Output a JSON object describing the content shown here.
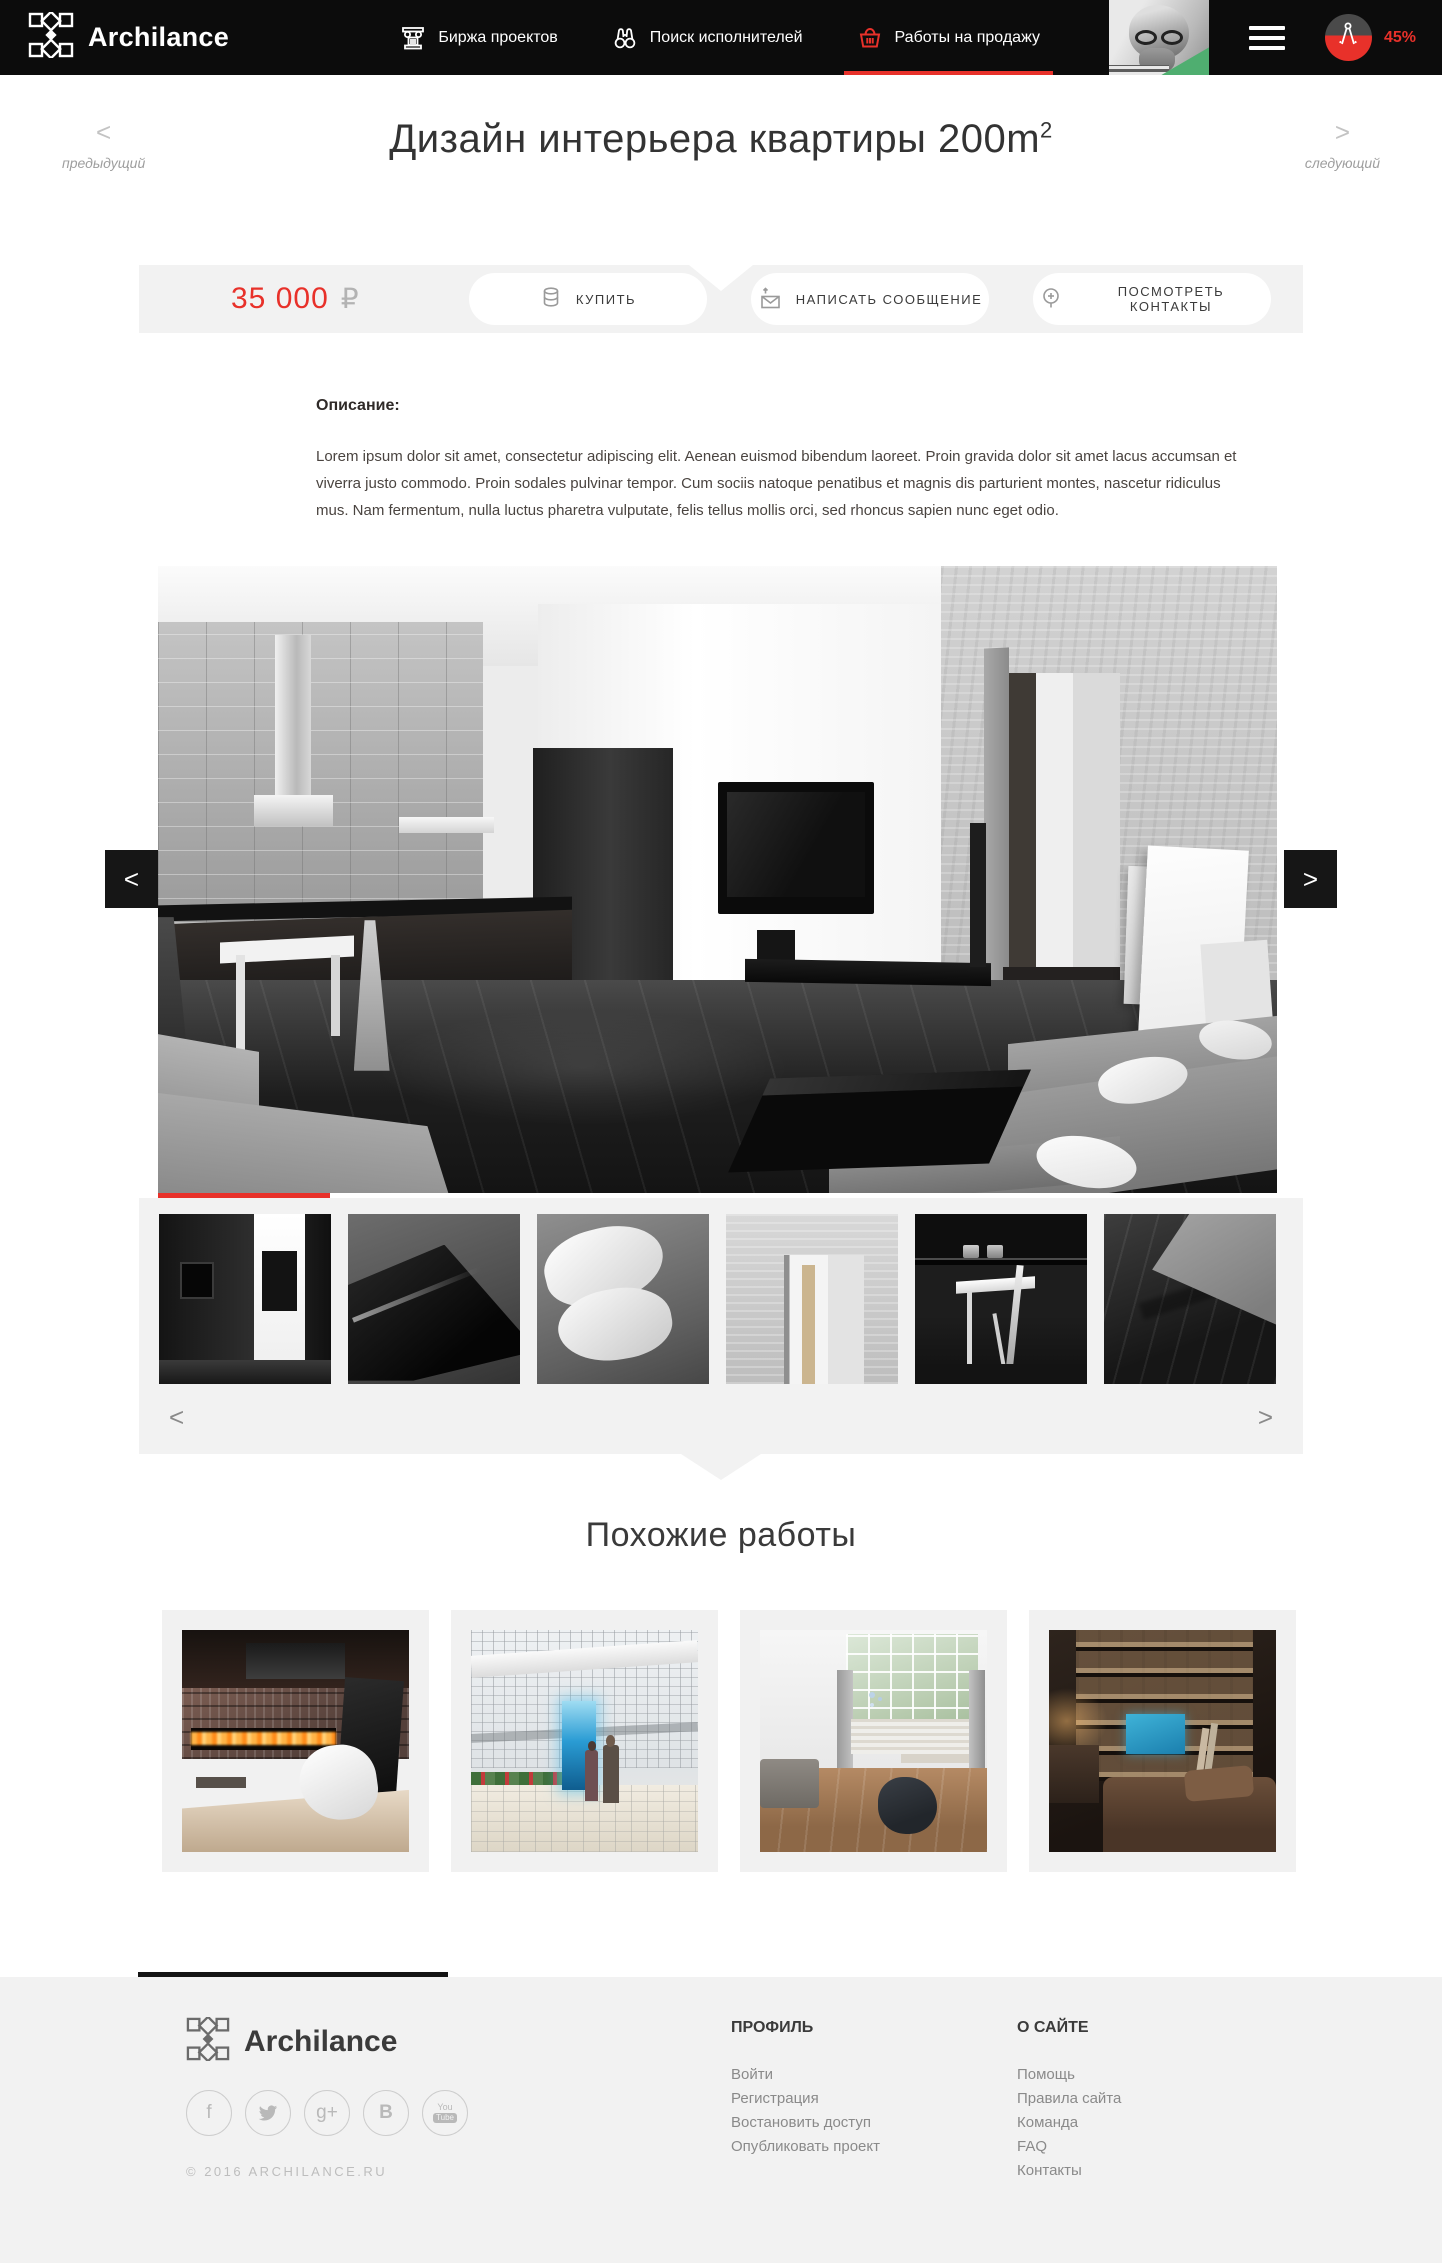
{
  "colors": {
    "accent": "#E8312A",
    "header_bg": "#0C0C0C",
    "band_bg": "#F2F2F2"
  },
  "header": {
    "brand": "Archilance",
    "nav": [
      {
        "label": "Биржа проектов",
        "icon": "column-icon",
        "active": false
      },
      {
        "label": "Поиск исполнителей",
        "icon": "binoculars-icon",
        "active": false
      },
      {
        "label": "Работы на продажу",
        "icon": "basket-icon",
        "active": true
      }
    ],
    "progress": "45%"
  },
  "work": {
    "prev_label": "предыдущий",
    "next_label": "следующий",
    "title": "Дизайн интерьера квартиры 200m",
    "title_sup": "2",
    "price": "35 000",
    "currency": "₽",
    "actions": [
      {
        "label": "КУПИТЬ",
        "icon": "coins-icon"
      },
      {
        "label": "НАПИСАТЬ СООБЩЕНИЕ",
        "icon": "envelope-icon"
      },
      {
        "label": "ПОСМОТРЕТЬ КОНТАКТЫ",
        "icon": "pin-icon"
      }
    ],
    "description_heading": "Описание:",
    "description": "Lorem ipsum dolor sit amet, consectetur adipiscing elit. Aenean euismod bibendum laoreet. Proin gravida dolor sit amet lacus accumsan et viverra justo commodo. Proin sodales pulvinar tempor. Cum sociis natoque penatibus et magnis dis parturient montes, nascetur ridiculus mus. Nam fermentum, nulla luctus pharetra vulputate, felis tellus mollis orci, sed rhoncus sapien nunc eget odio."
  },
  "ui": {
    "prev_glyph": "<",
    "next_glyph": ">"
  },
  "similar": {
    "heading": "Похожие работы"
  },
  "footer": {
    "brand": "Archilance",
    "copyright": "© 2016 ARCHILANCE.RU",
    "socials": {
      "facebook": "f",
      "google_plus": "g+",
      "vk": "B",
      "youtube_top": "You",
      "youtube_bottom": "Tube"
    },
    "columns": [
      {
        "title": "ПРОФИЛЬ",
        "links": [
          "Войти",
          "Регистрация",
          "Востановить доступ",
          "Опубликовать проект"
        ]
      },
      {
        "title": "О САЙТЕ",
        "links": [
          "Помощь",
          "Правила сайта",
          "Команда",
          "FAQ",
          "Контакты"
        ]
      }
    ]
  }
}
